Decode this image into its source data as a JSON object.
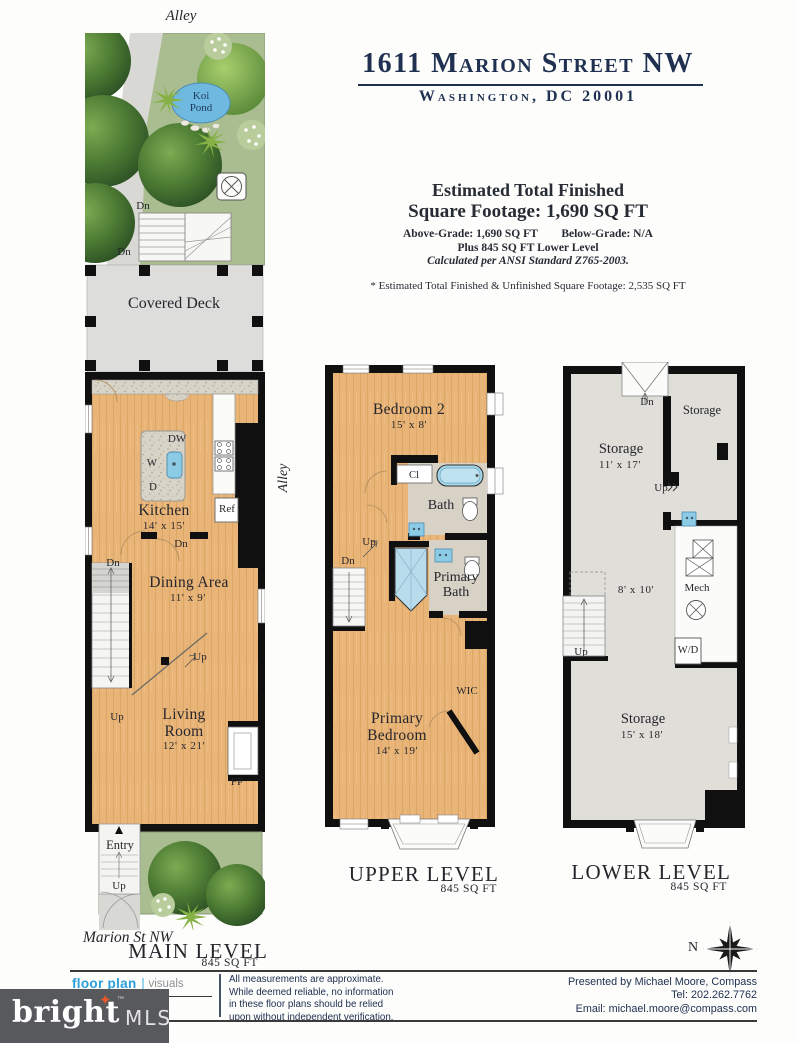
{
  "header": {
    "title": "1611 Marion Street NW",
    "city": "Washington, DC 20001",
    "est_line1": "Estimated Total Finished",
    "est_line2": "Square Footage: 1,690 SQ FT",
    "above_grade": "Above-Grade: 1,690 SQ FT",
    "below_grade": "Below-Grade: N/A",
    "plus_line": "Plus 845 SQ FT Lower Level",
    "ansi_line": "Calculated per ANSI Standard Z765-2003.",
    "note_line": "* Estimated Total Finished & Unfinished Square Footage: 2,535 SQ FT"
  },
  "main": {
    "alley_top": "Alley",
    "alley_side": "Alley",
    "koi_pond": "Koi Pond",
    "deck_dn1": "Dn",
    "deck_dn2": "Dn",
    "covered_deck": "Covered Deck",
    "island_dw": "DW",
    "island_w": "W",
    "island_d": "D",
    "ref": "Ref",
    "kitchen_name": "Kitchen",
    "kitchen_dims": "14' x 15'",
    "kitchen_dn": "Dn",
    "stairs_dn": "Dn",
    "stairs_up": "Up",
    "dining_name": "Dining Area",
    "dining_dims": "11' x 9'",
    "mid_up": "Up",
    "living_name": "Living Room",
    "living_dims": "12' x 21'",
    "fp": "FP",
    "entry": "Entry",
    "entry_up": "Up",
    "street": "Marion St NW",
    "level_name": "MAIN LEVEL",
    "level_sqft": "845 SQ FT"
  },
  "upper": {
    "bedroom2_name": "Bedroom 2",
    "bedroom2_dims": "15' x 8'",
    "cl": "Cl",
    "bath": "Bath",
    "up": "Up",
    "dn": "Dn",
    "primary_bath": "Primary Bath",
    "wic": "WIC",
    "primary_bedroom_name": "Primary Bedroom",
    "primary_bedroom_dims": "14' x 19'",
    "level_name": "UPPER LEVEL",
    "level_sqft": "845 SQ FT"
  },
  "lower": {
    "dn": "Dn",
    "storage_right": "Storage",
    "storage1_name": "Storage",
    "storage1_dims": "11' x 17'",
    "up_mid": "Up",
    "room_dims": "8' x 10'",
    "mech": "Mech",
    "wd": "W/D",
    "up_stairs": "Up",
    "storage2_name": "Storage",
    "storage2_dims": "15' x 18'",
    "level_name": "LOWER LEVEL",
    "level_sqft": "845 SQ FT"
  },
  "compass": {
    "north": "N"
  },
  "footer": {
    "logo_floorplan": "floor plan",
    "logo_visuals": "visuals",
    "disclaimer": [
      "All measurements are approximate.",
      "While deemed reliable, no information",
      "in these floor plans should be relied",
      "upon without independent verification."
    ],
    "presented": "Presented by Michael Moore, Compass",
    "tel": "Tel: 202.262.7762",
    "email": "Email: michael.moore@compass.com",
    "brand_name": "bright",
    "brand_tm": "™",
    "brand_mls": "MLS"
  },
  "colors": {
    "accent_navy": "#1f3050",
    "floor_tan": "#e8b478",
    "garden_green": "#a9bd90",
    "water_blue": "#7cc3e2",
    "logo_blue": "#2ba0d8",
    "brand_gray": "#58595c",
    "star_orange": "#e8562a"
  }
}
